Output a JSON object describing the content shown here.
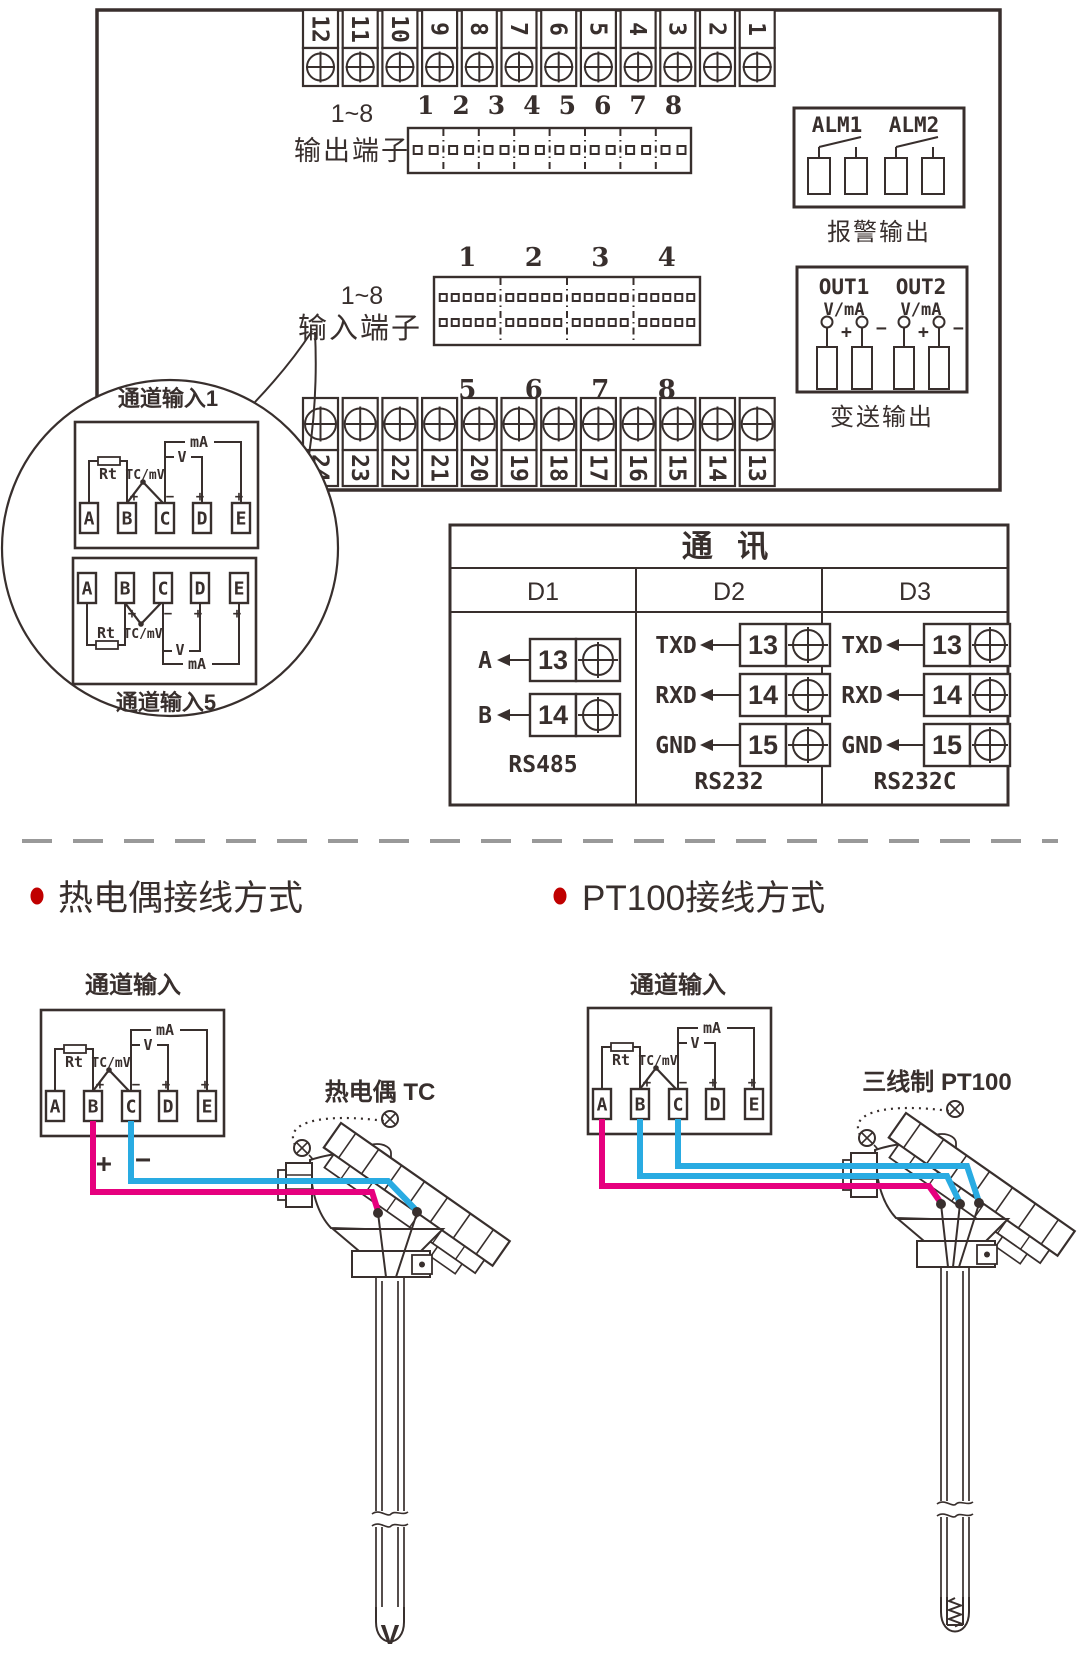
{
  "panel": {
    "strip_top": [
      "12",
      "11",
      "10",
      "9",
      "8",
      "7",
      "6",
      "5",
      "4",
      "3",
      "2",
      "1"
    ],
    "strip_bottom": [
      "24",
      "23",
      "22",
      "21",
      "20",
      "19",
      "18",
      "17",
      "16",
      "15",
      "14",
      "13"
    ],
    "output_block": {
      "range": "1~8",
      "name": "输出端子",
      "pins": [
        "1",
        "2",
        "3",
        "4",
        "5",
        "6",
        "7",
        "8"
      ]
    },
    "input_block": {
      "range": "1~8",
      "name": "输入端子",
      "pins_top": [
        "1",
        "2",
        "3",
        "4"
      ],
      "pins_bottom": [
        "5",
        "6",
        "7",
        "8"
      ]
    },
    "alarm": {
      "labels": [
        "ALM1",
        "ALM2"
      ],
      "caption": "报警输出"
    },
    "transmit": {
      "labels": [
        "OUT1",
        "OUT2"
      ],
      "sub": "V/mA",
      "plus": "+",
      "minus": "−",
      "caption": "变送输出"
    },
    "comm": {
      "title": "通  讯",
      "columns": [
        {
          "name": "D1",
          "rows": [
            [
              "A",
              "13"
            ],
            [
              "B",
              "14"
            ]
          ],
          "caption": "RS485"
        },
        {
          "name": "D2",
          "rows": [
            [
              "TXD",
              "13"
            ],
            [
              "RXD",
              "14"
            ],
            [
              "GND",
              "15"
            ]
          ],
          "caption": "RS232"
        },
        {
          "name": "D3",
          "rows": [
            [
              "TXD",
              "13"
            ],
            [
              "RXD",
              "14"
            ],
            [
              "GND",
              "15"
            ]
          ],
          "caption": "RS232C"
        }
      ]
    }
  },
  "channel": {
    "terminals": [
      "A",
      "B",
      "C",
      "D",
      "E"
    ],
    "rt": "Rt",
    "tcmv": "TC/mV",
    "v": "V",
    "ma": "mA",
    "plus": "+",
    "minus": "−"
  },
  "balloon": {
    "top_label": "通道输入1",
    "bottom_label": "通道输入5"
  },
  "sections": {
    "tc": {
      "heading": "热电偶接线方式",
      "channel": "通道输入",
      "sensor": "热电偶 TC",
      "plus": "+",
      "minus": "−"
    },
    "pt": {
      "heading": "PT100接线方式",
      "channel": "通道输入",
      "sensor": "三线制 PT100"
    }
  },
  "colors": {
    "ink": "#382f2d",
    "wire_plus": "#e6007e",
    "wire_minus": "#29abe2",
    "bullet": "#c00000",
    "divider": "#999999"
  }
}
